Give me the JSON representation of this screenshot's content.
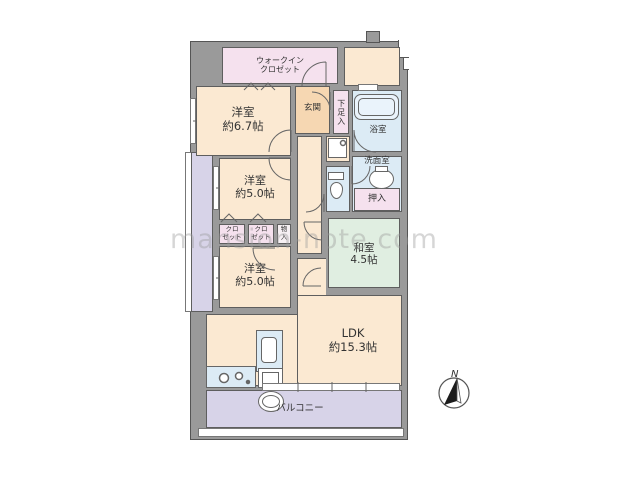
{
  "floorplan": {
    "watermark": "mansion-note.com",
    "compass": {
      "label": "N"
    },
    "rooms": {
      "walk_in_closet": {
        "label": "ウォークイン\nクロゼット"
      },
      "bedroom_6_7": {
        "label": "洋室\n約6.7帖"
      },
      "entrance": {
        "label": "玄関"
      },
      "shoe_cabinet": {
        "label": "下足入"
      },
      "bathroom": {
        "label": "浴室"
      },
      "washroom": {
        "label": "洗面室"
      },
      "futon_closet": {
        "label": "押入"
      },
      "bedroom_5_0_middle": {
        "label": "洋室\n約5.0帖"
      },
      "closet_left": {
        "label": "クロ\nゼット"
      },
      "closet_right": {
        "label": "クロ\nゼット"
      },
      "storage": {
        "label": "物\n入"
      },
      "japanese_room": {
        "label": "和室\n4.5帖"
      },
      "bedroom_5_0_lower": {
        "label": "洋室\n約5.0帖"
      },
      "ldk": {
        "label": "LDK\n約15.3帖"
      },
      "balcony": {
        "label": "バルコニー"
      }
    },
    "colors": {
      "wall": "#9a9a9a",
      "room_cream": "#fbe9d2",
      "entrance_orange": "#f6d7b2",
      "closet_pink": "#f5e1ee",
      "wet_blue": "#dcebf5",
      "tatami_green": "#e0eee1",
      "balcony_purple": "#d7d3e8"
    }
  }
}
